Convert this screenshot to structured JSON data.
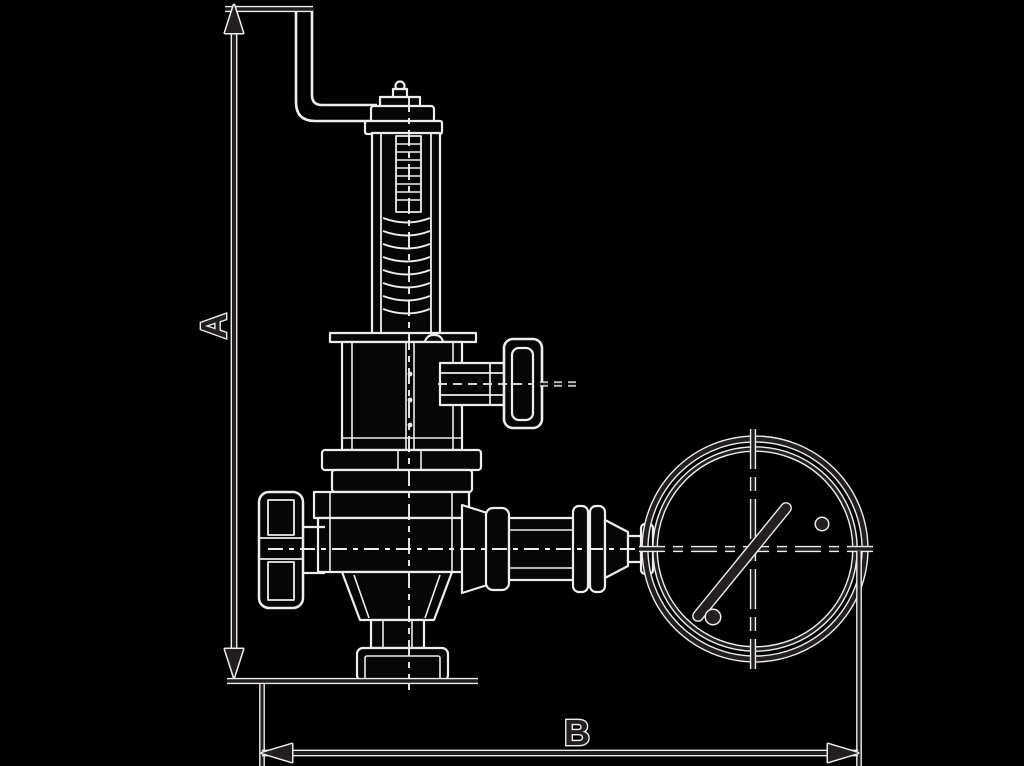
{
  "figure": {
    "title": "Safety overflow valve with pressure gauge - dimensional line drawing",
    "type": "technical-line-drawing",
    "background_color": "#000000",
    "line_color": "#231f20",
    "halo_color": "#ededed"
  },
  "dimension_labels": {
    "vertical": "A",
    "horizontal": "B"
  }
}
